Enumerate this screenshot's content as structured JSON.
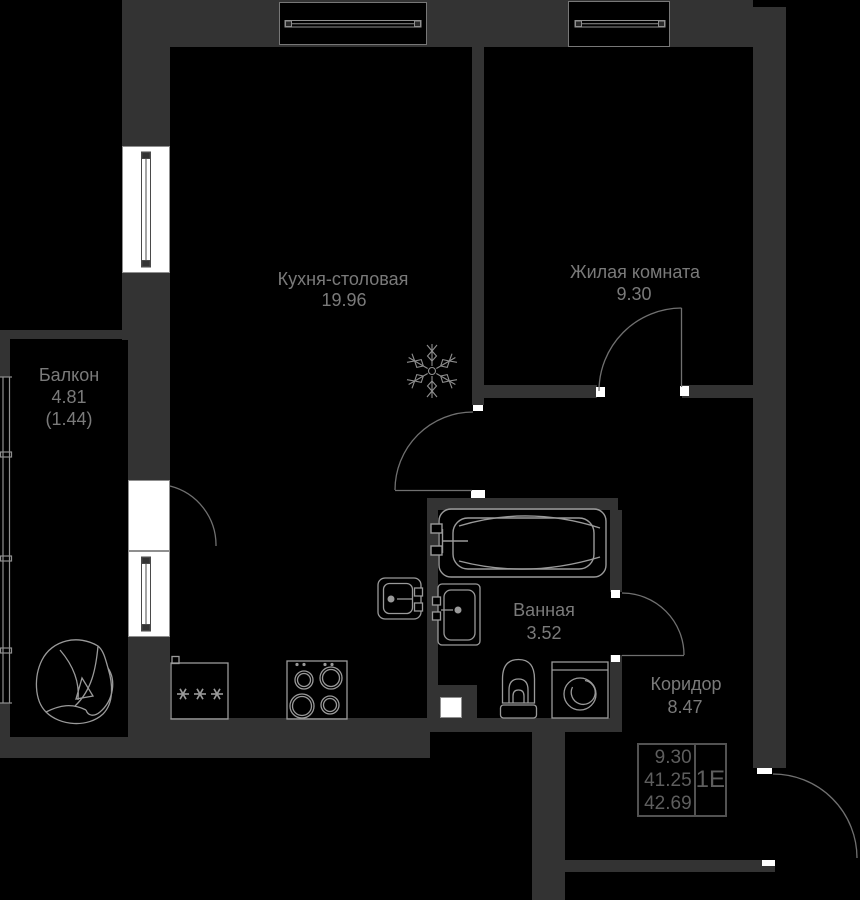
{
  "plan": {
    "title": "Apartment floor plan 1E",
    "rooms": [
      {
        "id": "kitchen",
        "name": "Кухня-столовая",
        "area": "19.96"
      },
      {
        "id": "living",
        "name": "Жилая комната",
        "area": "9.30"
      },
      {
        "id": "balcony",
        "name": "Балкон",
        "area": "4.81",
        "area_reduced": "(1.44)"
      },
      {
        "id": "bathroom",
        "name": "Ванная",
        "area": "3.52"
      },
      {
        "id": "corridor",
        "name": "Коридор",
        "area": "8.47"
      }
    ],
    "info_table": {
      "rows": [
        "9.30",
        "41.25",
        "42.69"
      ],
      "unit_type": "1Е"
    },
    "colors": {
      "wall": "#333333",
      "background": "#000000",
      "opening": "#ffffff",
      "fixture_line": "#9a9a9a",
      "door_arc": "#707070",
      "label_text": "#7a7a7a",
      "table_text": "#5e5e5e"
    },
    "icons": [
      "snowflake-icon",
      "fridge-frost-asterisks-icon",
      "bathtub-icon",
      "toilet-icon",
      "washing-machine-icon",
      "bathroom-sink-icon",
      "kitchen-sink-icon",
      "stove-icon",
      "armchair-icon"
    ]
  }
}
